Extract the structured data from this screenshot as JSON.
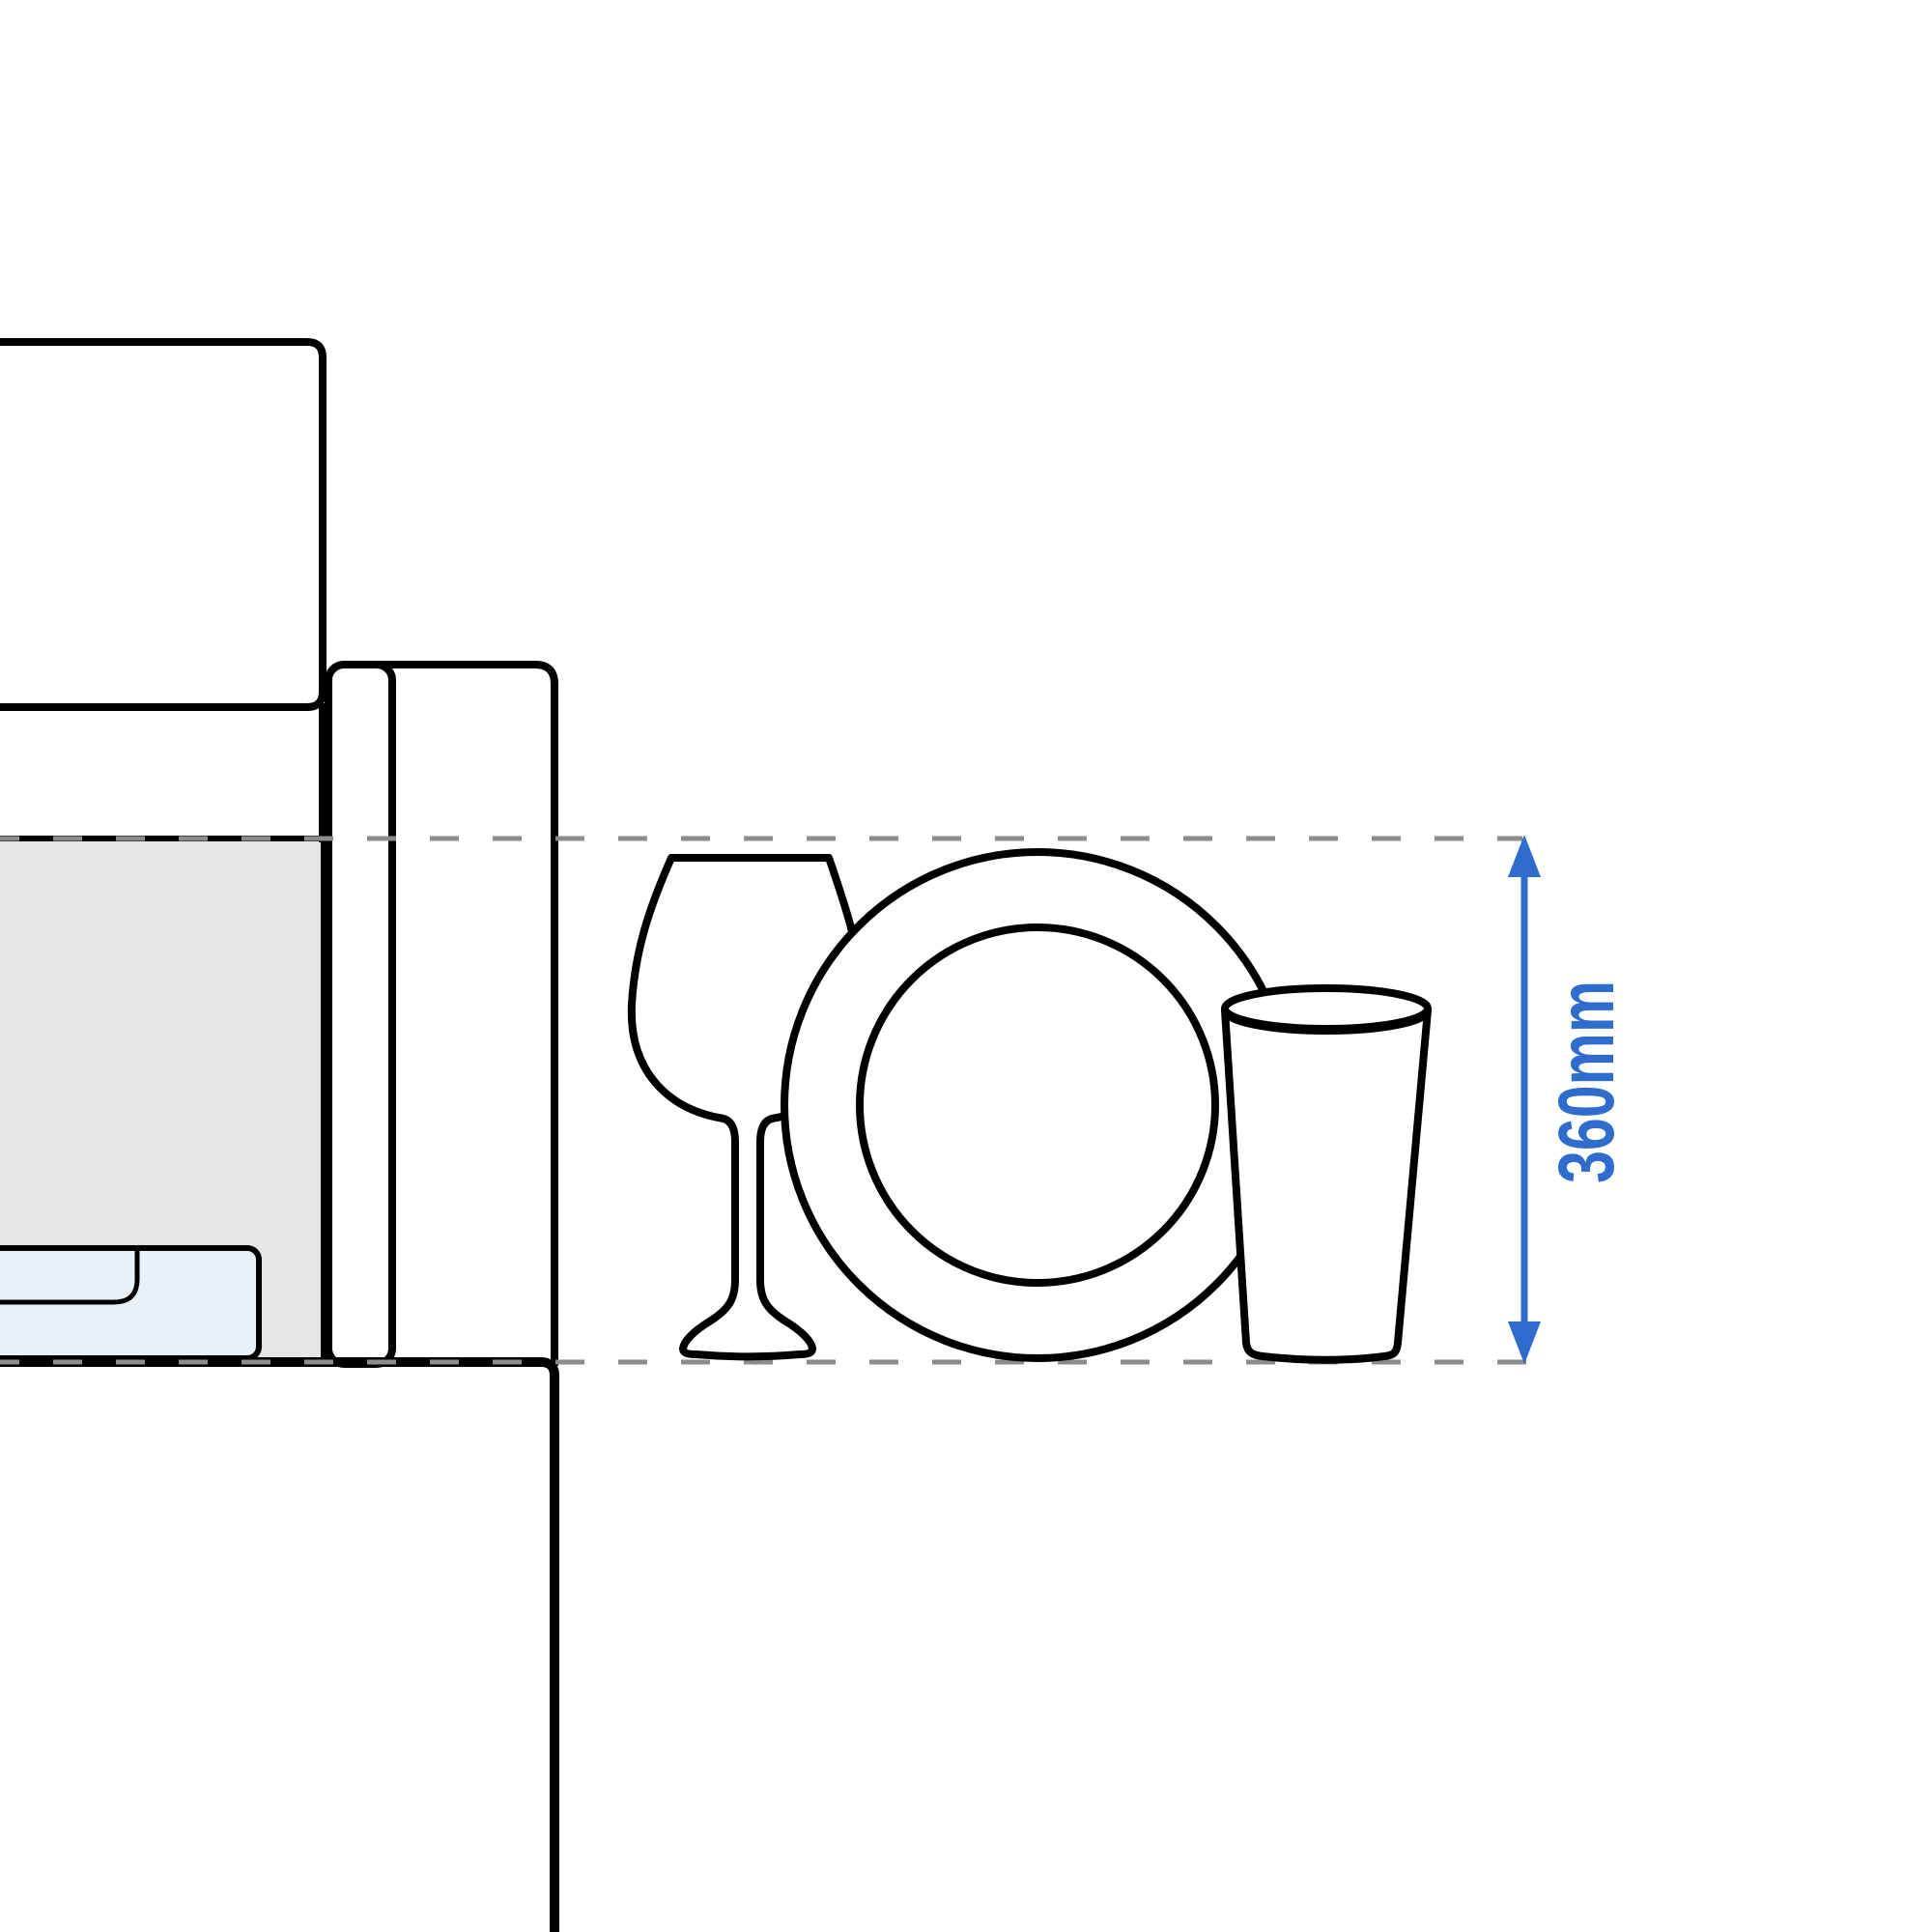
{
  "diagram": {
    "type": "appliance-clearance-side-view",
    "dimension": {
      "label": "360mm",
      "orientation": "vertical",
      "color": "#2f6cce"
    },
    "objects": [
      "upper-cabinet",
      "appliance-cavity",
      "pull-out-tray",
      "door-panel",
      "plinth",
      "wine-glass",
      "dinner-plate",
      "tumbler-glass"
    ],
    "colors": {
      "outline": "#000000",
      "cavity_fill": "#e5e5e4",
      "tray_fill": "#e9f1f8",
      "dash": "#8c8c8c",
      "background": "#ffffff"
    }
  }
}
